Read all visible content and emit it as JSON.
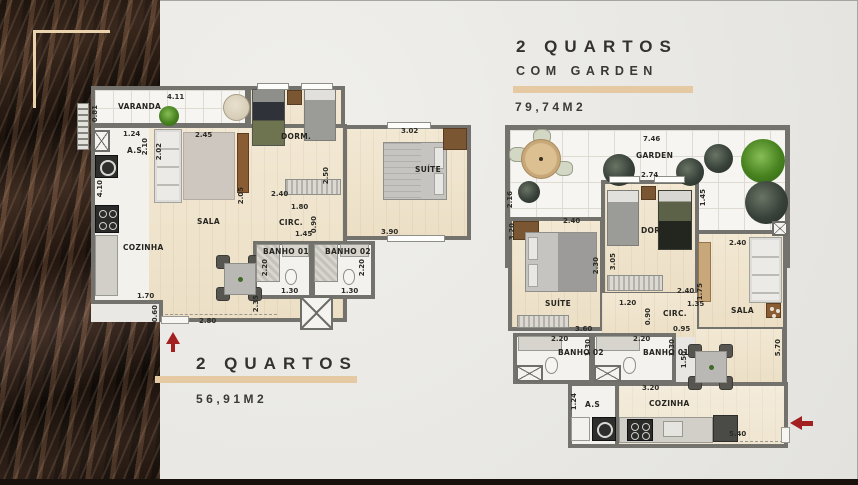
{
  "sheet": {
    "background_color": "#e9e8e4",
    "accent_color": "#e5c9a3",
    "arrow_color": "#a32020",
    "wall_color": "#73726c"
  },
  "plan_small": {
    "title": "2 QUARTOS",
    "area": "56,91M2",
    "labels": {
      "varanda": "VARANDA",
      "as": "A.S",
      "cozinha": "COZINHA",
      "sala": "SALA",
      "circ": "CIRC.",
      "dorm": "DORM.",
      "suite": "SUÍTE",
      "banho01": "BANHO 01",
      "banho02": "BANHO 02"
    },
    "dims": {
      "varanda_w": "4.11",
      "varanda_d": "0.81",
      "as_w": "1.24",
      "as_d": "2.10",
      "sala_w": "2.45",
      "sala_d": "2.02",
      "cozinha_d": "4.10",
      "dorm_w": "2.40",
      "dorm_d": "2.50",
      "suite_w": "3.02",
      "suite_bottom_w": "3.90",
      "circ_w": "1.80",
      "circ_d": "0.90",
      "hall_w": "1.45",
      "sala_d2": "2.05",
      "dining_d": "2.35",
      "cozinha_step_w": "1.70",
      "cozinha_step_d": "0.60",
      "entry_w": "2.80",
      "banho01_d": "2.20",
      "banho01_w": "1.30",
      "banho02_d": "2.20",
      "banho02_w": "1.30"
    }
  },
  "plan_garden": {
    "title_line1": "2 QUARTOS",
    "title_line2": "COM GARDEN",
    "area": "79,74M2",
    "labels": {
      "garden": "GARDEN",
      "dorm": "DORM.",
      "suite": "SUÍTE",
      "sala": "SALA",
      "circ": "CIRC.",
      "banho01": "BANHO 01",
      "banho02": "BANHO 02",
      "as": "A.S",
      "cozinha": "COZINHA"
    },
    "dims": {
      "garden_w": "7.46",
      "garden_left_d": "2.16",
      "dorm_w": "2.74",
      "dorm_right_d": "1.45",
      "suite_w": "2.40",
      "suite_left_d": "3.20",
      "suite_right_d": "2.30",
      "dorm_left_d": "3.05",
      "dorm_bottom_w": "2.40",
      "suite_bottom_w": "3.60",
      "circ_w1": "1.20",
      "circ_w2": "1.35",
      "circ_d": "0.90",
      "circ_w3": "0.95",
      "sala_w": "2.40",
      "sala_left_d": "1.75",
      "banho02_w": "2.20",
      "banho02_d": "1.30",
      "banho01_w": "2.20",
      "banho01_d": "1.30",
      "dining_d": "1.50",
      "side_d": "5.70",
      "as_d": "1.24",
      "cozinha_w": "3.20",
      "bottom_w": "5.40"
    }
  }
}
